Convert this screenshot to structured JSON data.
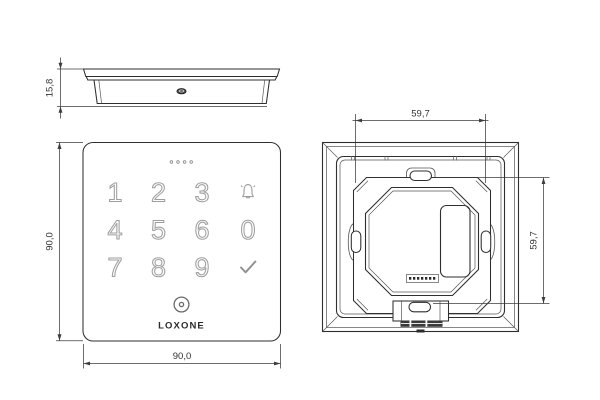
{
  "side_view": {
    "thickness_dim": "15,8"
  },
  "front_view": {
    "keys": [
      "1",
      "2",
      "3",
      "4",
      "5",
      "6",
      "7",
      "8",
      "9",
      "0"
    ],
    "brand": "LOXONE",
    "height_dim": "90,0",
    "width_dim": "90,0"
  },
  "back_view": {
    "mount_hole_spacing_h": "59,7",
    "mount_hole_spacing_v": "59,7"
  },
  "icons": {
    "bell": "doorbell-bell-outline",
    "check": "checkmark",
    "nfc": "concentric-target-circle",
    "leds": "four-dot-status-row"
  },
  "colors": {
    "background": "#ffffff",
    "line": "#2f2f2f",
    "line_thin": "#555555",
    "dim_line": "#3d3d3d",
    "dim_text": "#333333",
    "key_outline": "#9e9e9e",
    "brand_text": "#2b2b2b"
  }
}
